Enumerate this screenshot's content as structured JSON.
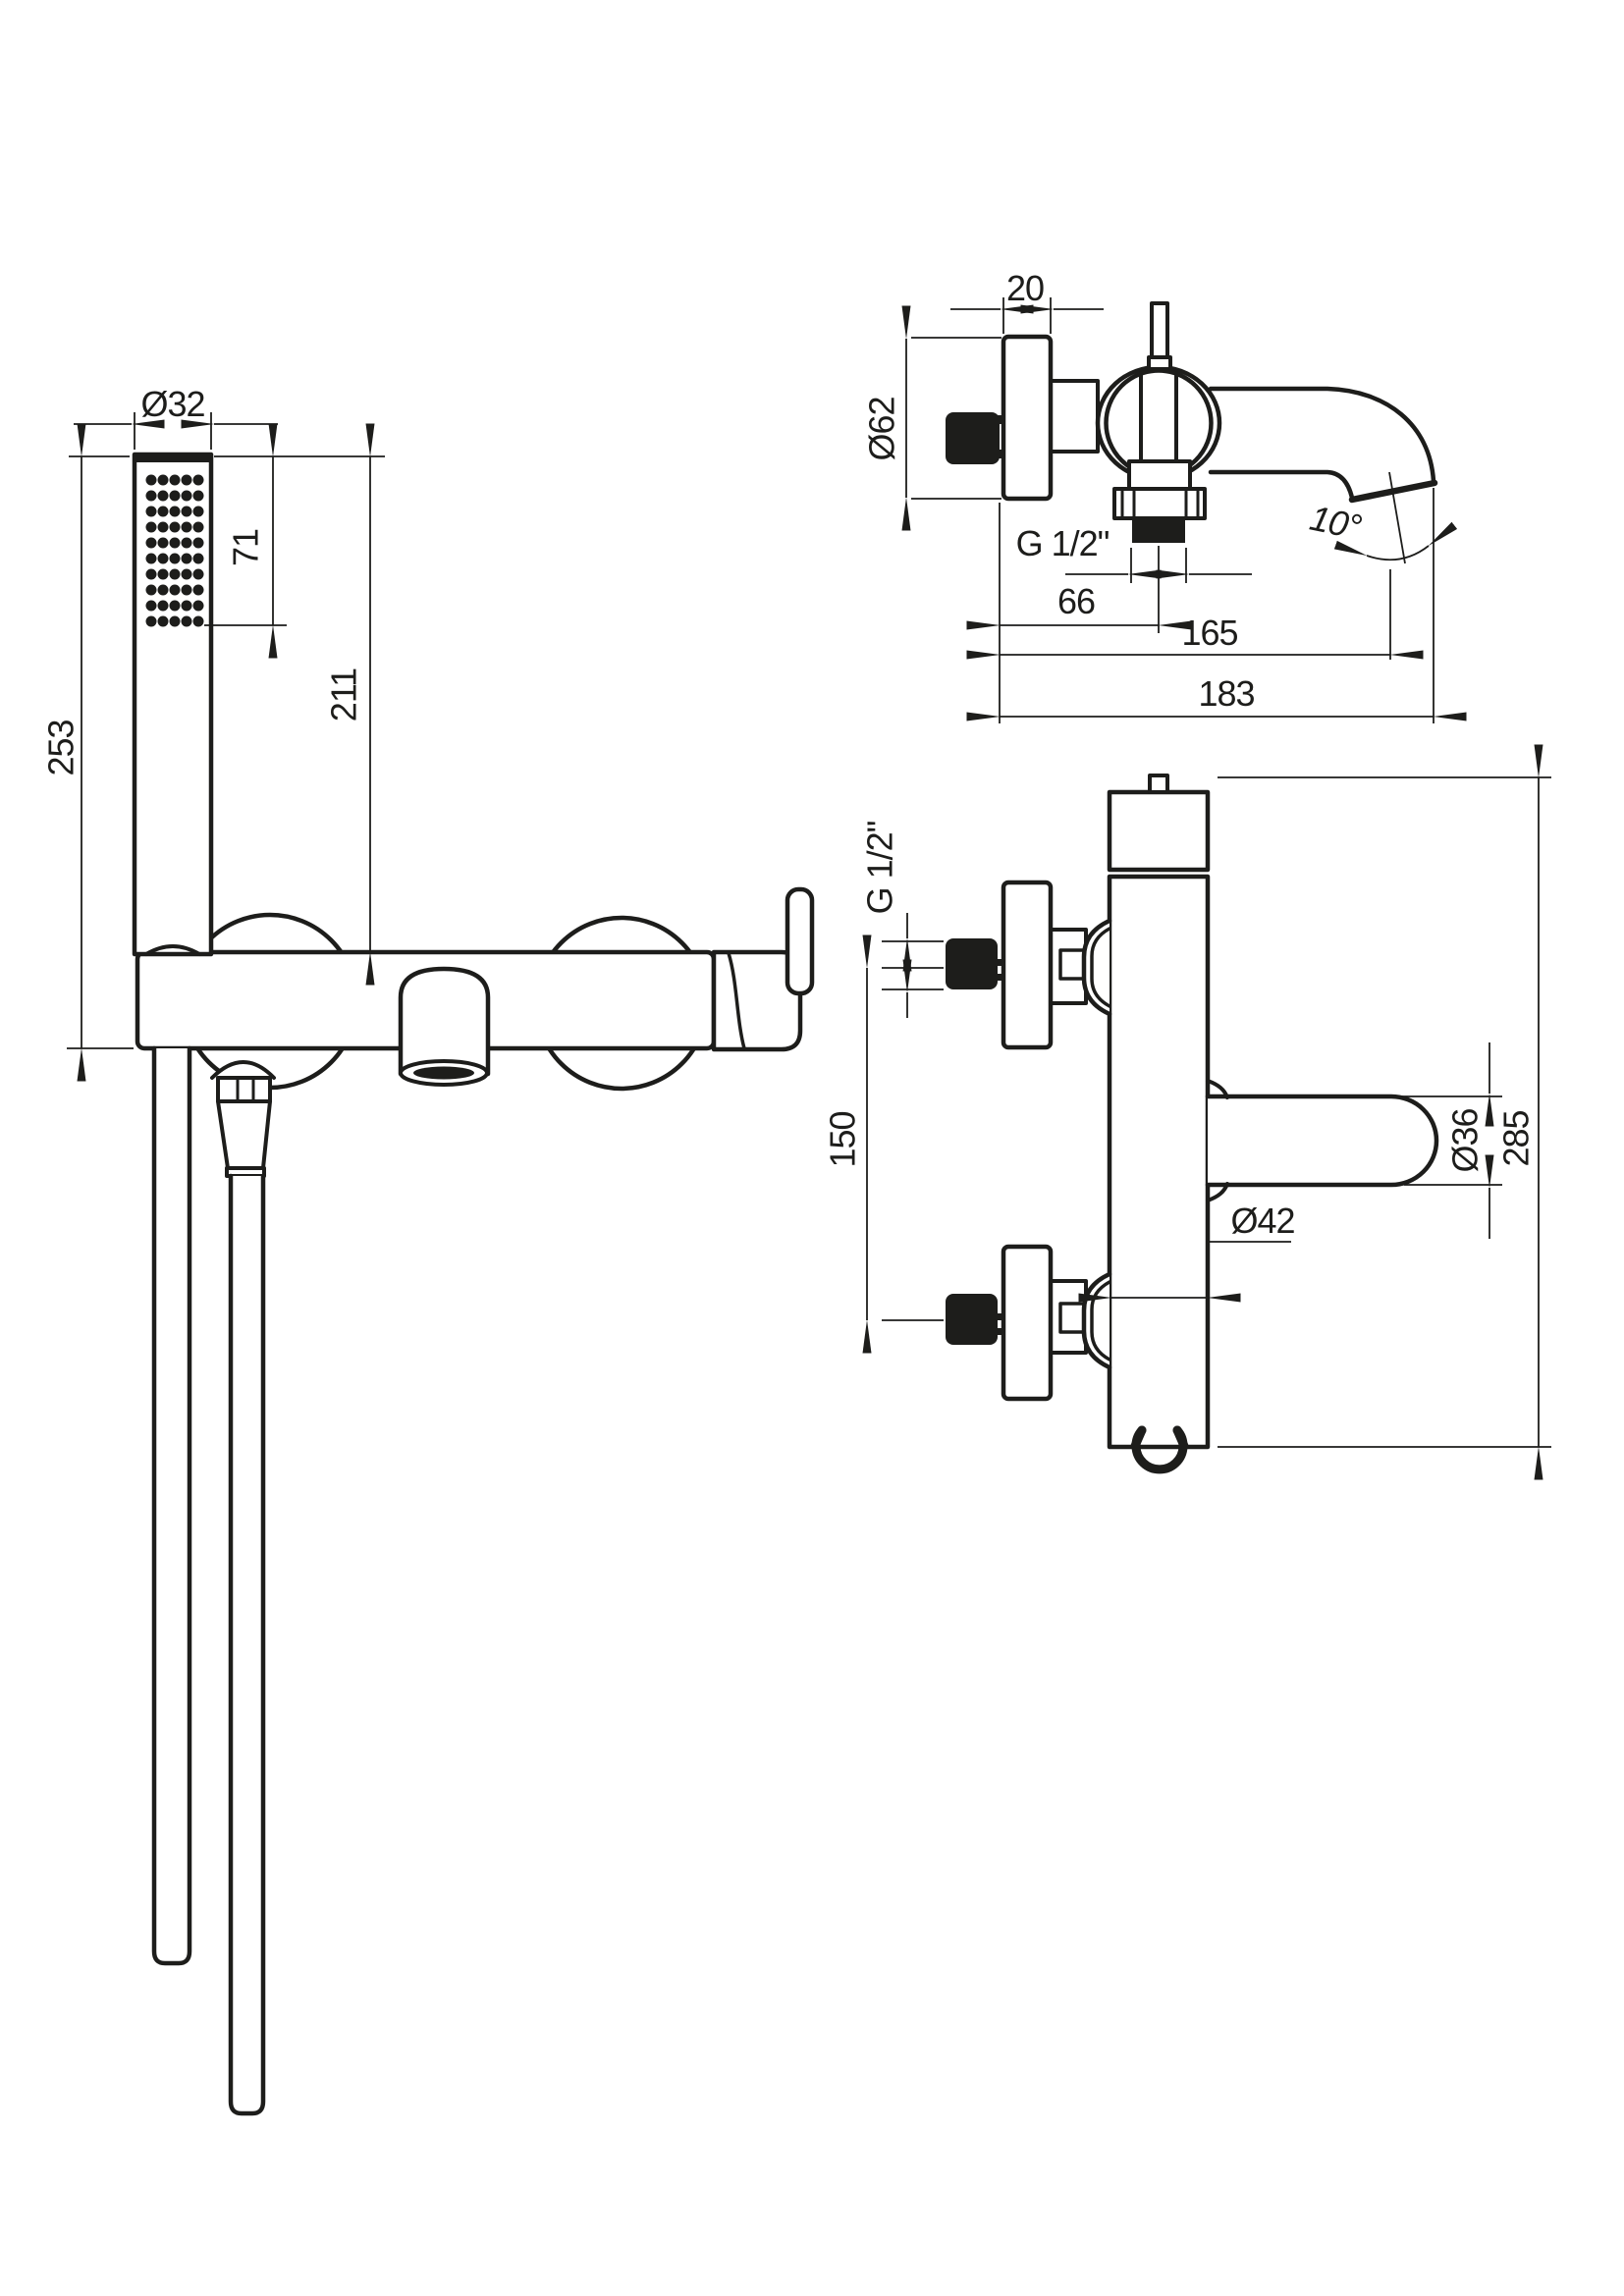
{
  "drawing": {
    "ink_color": "#1d1d1b",
    "background_color": "#ffffff",
    "views": {
      "front": {
        "title": "front view with hand shower",
        "dims": {
          "head_diameter": "Ø32",
          "spray_face_length": "71",
          "handset_length": "211",
          "overall_length": "253"
        }
      },
      "spout_profile": {
        "title": "spout side profile",
        "dims": {
          "rosette_depth": "20",
          "rosette_diameter": "Ø62",
          "outlet_thread": "G 1/2\"",
          "thread_offset": "66",
          "spout_reach": "165",
          "overall_reach": "183",
          "spout_angle": "10°"
        }
      },
      "body_profile": {
        "title": "body side profile",
        "dims": {
          "inlet_thread": "G 1/2\"",
          "inlet_spacing": "150",
          "lever_diameter": "Ø36",
          "overall_height": "285",
          "body_diameter": "Ø42"
        }
      }
    }
  }
}
